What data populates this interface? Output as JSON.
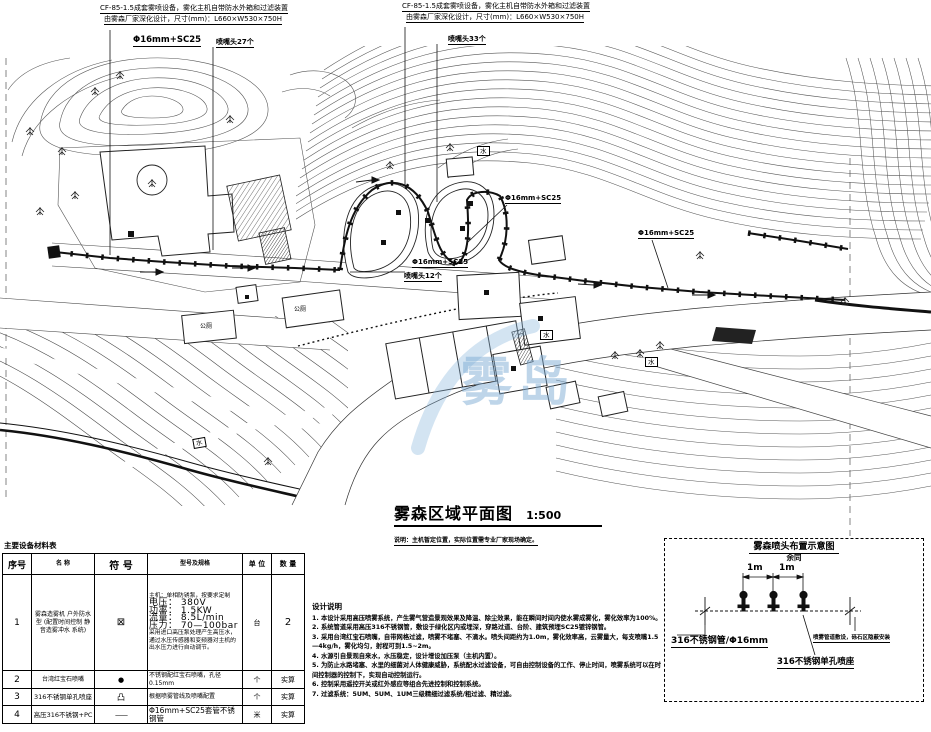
{
  "annotations": {
    "left": {
      "line1": "CF-85-1.5成套雾喷设备，雾化主机自带防水外箱和过滤装置",
      "line2": "由雾森厂家深化设计，尺寸(mm)：L660×W530×750H",
      "pipe": "Φ16mm+SC25",
      "nozzles": "喷嘴头27个"
    },
    "middle": {
      "line1": "CF-85-1.5成套雾喷设备，雾化主机自带防水外箱和过滤装置",
      "line2": "由雾森厂家深化设计，尺寸(mm)：L660×W530×750H",
      "nozzles": "喷嘴头33个"
    },
    "pipe_a": "Φ16mm+SC25",
    "pipe_b": "Φ16mm+SC25",
    "pipe_c": "Φ16mm+SC25",
    "nozzles12": "喷嘴头12个"
  },
  "plan_labels": {
    "toilet1": "公厕",
    "toilet2": "公厕",
    "water1": "水",
    "water2": "水",
    "water3": "水",
    "water4": "水"
  },
  "title_block": {
    "title": "雾森区域平面图",
    "scale": "1:500",
    "note": "说明：主机暂定位置，实际位置需专业厂家现场确定。"
  },
  "materials_table": {
    "title": "主要设备材料表",
    "headers": [
      "序号",
      "名 称",
      "符 号",
      "型号及规格",
      "单 位",
      "数 量"
    ],
    "rows": [
      {
        "no": "1",
        "name": "雾森造雾机 户外防水型 (配置时间控制 静音造雾冲水 系统)",
        "symbol": "⊠",
        "spec_lines": [
          "主机：单相防锈泵，按要求定制",
          "电压： 380V",
          "功率： 1.5KW",
          "流量： 8.5L/min",
          "压力： 70—100bar",
          "采用进口高压泵处理产生高压水，通过水压传感器和变频器对主机的出水压力进行自动调节。"
        ],
        "unit": "台",
        "qty": "2"
      },
      {
        "no": "2",
        "name": "台湾红宝石喷嘴",
        "symbol": "●",
        "spec": "不锈钢配红宝石喷嘴，孔径0.15mm",
        "unit": "个",
        "qty": "实算"
      },
      {
        "no": "3",
        "name": "316不锈钢单孔喷座",
        "symbol": "凸",
        "spec": "根据喷雾管线及喷嘴配置",
        "unit": "个",
        "qty": "实算"
      },
      {
        "no": "4",
        "name": "高压316不锈钢+PC",
        "symbol": "——",
        "spec": "Φ16mm+SC25套管不锈钢管",
        "unit": "米",
        "qty": "实算"
      }
    ]
  },
  "design_notes": {
    "title": "设计说明",
    "items": [
      "1. 本设计采用高压喷雾系统，产生雾气营造景观效果及降温、除尘效果，能在瞬间时间内使水雾成雾化，雾化效率为100%。",
      "2. 系统管道采用高压316不锈钢管，敷设于绿化区内或埋深，穿路过道、台阶、建筑预埋SC25镀锌钢管。",
      "3. 采用台湾红宝石喷嘴，自带网格过滤，喷雾不堵塞、不滴水。喷头间距约为1.0m，雾化效率高，云雾量大，每支喷嘴1.5—4kg/h，雾化均匀，射程可到1.5~2m。",
      "4. 水源引自景观自来水，水压稳定，设计增设加压泵（主机内置）。",
      "5. 为防止水路堵塞、水里的细菌对人体健康威胁，系统配水过滤设备，可自由控制设备的工作、停止时间，喷雾系统可以在时间控制器的控制下，实现自动控制运行。",
      "6. 控制采用遥控开关或红外感应等组合先进控制和控制系统。",
      "7. 过滤系统：5UM、5UM、1UM三级精细过滤系统/粗过滤、精过滤。"
    ]
  },
  "detail": {
    "label_pipe": "316不锈钢管/Φ16mm",
    "label_nozzle": "316不锈钢单孔喷座",
    "label_install": "喷雾管道敷设，砾石区隐蔽安装",
    "dim1": "1m",
    "dim2": "1m",
    "title": "雾森喷头布置示意图",
    "subtitle": "余同"
  },
  "watermark": {
    "text": "雾岛"
  }
}
